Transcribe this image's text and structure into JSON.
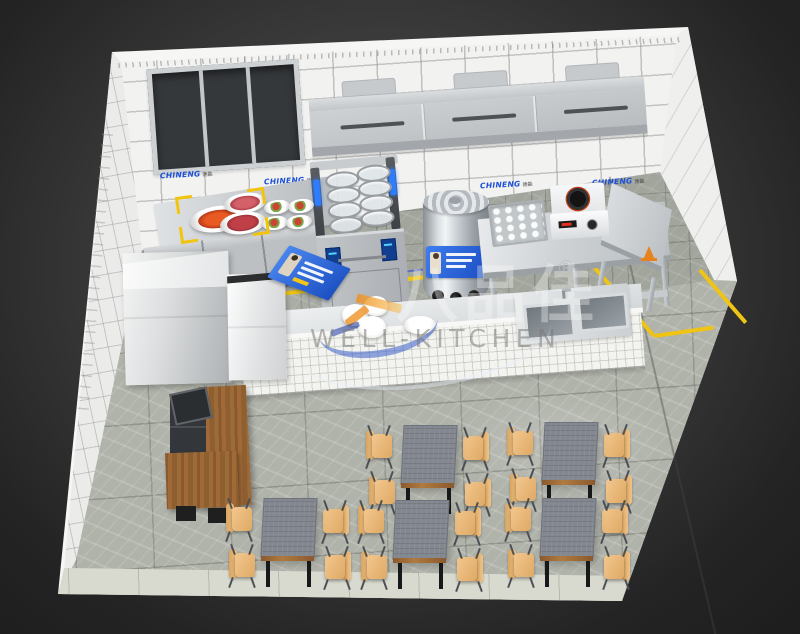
{
  "scene": {
    "description": "3D isometric cut-away render of a commercial restaurant kitchen with open dining area",
    "render_style": "photoreal visualization"
  },
  "watermark": {
    "brand_cn": "八品佳",
    "registered_mark": "®",
    "brand_en": "WELL-KITCHEN"
  },
  "wall_brand": {
    "name": "CHINENG",
    "name_cn": "驰能",
    "color": "#1b4fd8",
    "count": 4
  },
  "room": {
    "back_wall": "white ceramic tile",
    "floor": "grey marble tile",
    "zone_line_color": "#efc414"
  },
  "counts": {
    "window_panes": 3,
    "hood_sections": 3,
    "noodle_basket_rows": 4,
    "noodle_basket_columns": 2,
    "food_bowls": 4,
    "soup_pot_knobs": 3,
    "sink_basins": 2
  },
  "equipment": [
    {
      "name": "three-pane-window"
    },
    {
      "name": "exhaust-hood"
    },
    {
      "name": "prep-counter-with-dishes"
    },
    {
      "name": "crayfish-plate-highlighted"
    },
    {
      "name": "noodle-cooker-basket-lift"
    },
    {
      "name": "soup-boiler-pot"
    },
    {
      "name": "work-table"
    },
    {
      "name": "steam-tray"
    },
    {
      "name": "induction-cooker"
    },
    {
      "name": "double-sink"
    },
    {
      "name": "serving-pass-counter"
    },
    {
      "name": "ice-machine"
    },
    {
      "name": "upright-cabinet"
    },
    {
      "name": "cashier-counter-pos"
    },
    {
      "name": "safety-cone"
    }
  ],
  "dining": {
    "table_count": 5,
    "chairs_per_table": 4
  }
}
